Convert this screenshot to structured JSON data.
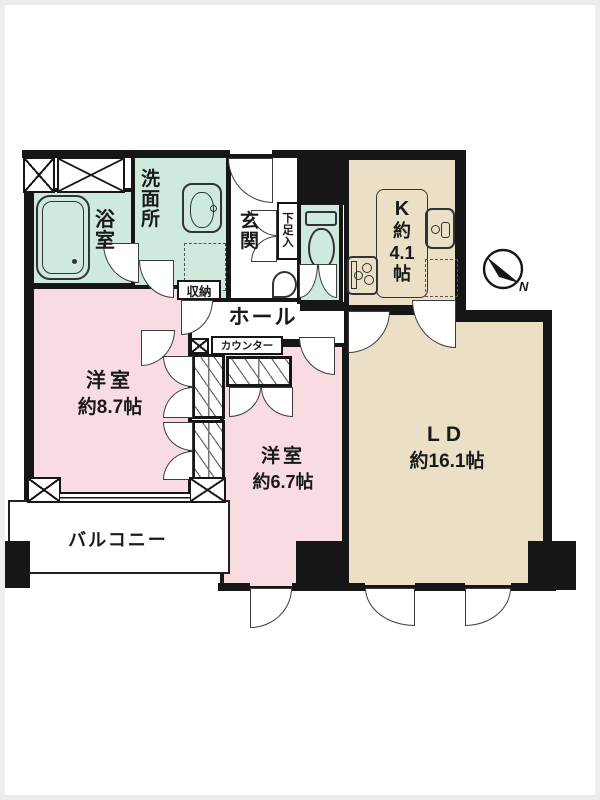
{
  "colors": {
    "wall": "#161616",
    "mint_room": "#cdeadd",
    "pink_room": "#f9dce2",
    "beige_room": "#ebdfc5",
    "door_line": "#3c3c3c"
  },
  "rooms": {
    "bath": {
      "chars": [
        "浴",
        "室"
      ]
    },
    "washroom": {
      "chars": [
        "洗",
        "面",
        "所"
      ]
    },
    "storage": {
      "label": "収納"
    },
    "entrance": {
      "chars": [
        "玄",
        "関"
      ]
    },
    "shoe_cabinet": {
      "chars": [
        "下",
        "足",
        "入"
      ]
    },
    "hall": {
      "label": "ホール"
    },
    "counter": {
      "label": "カウンター"
    },
    "kitchen": {
      "lines": [
        "K",
        "約",
        "4.1",
        "帖"
      ]
    },
    "western_room_87": {
      "name": "洋室",
      "size": "約8.7帖"
    },
    "western_room_67": {
      "name": "洋室",
      "size": "約6.7帖"
    },
    "living_dining": {
      "name": "LD",
      "size": "約16.1帖"
    },
    "balcony": {
      "label": "バルコニー"
    }
  },
  "compass": {
    "north_label": "N"
  }
}
